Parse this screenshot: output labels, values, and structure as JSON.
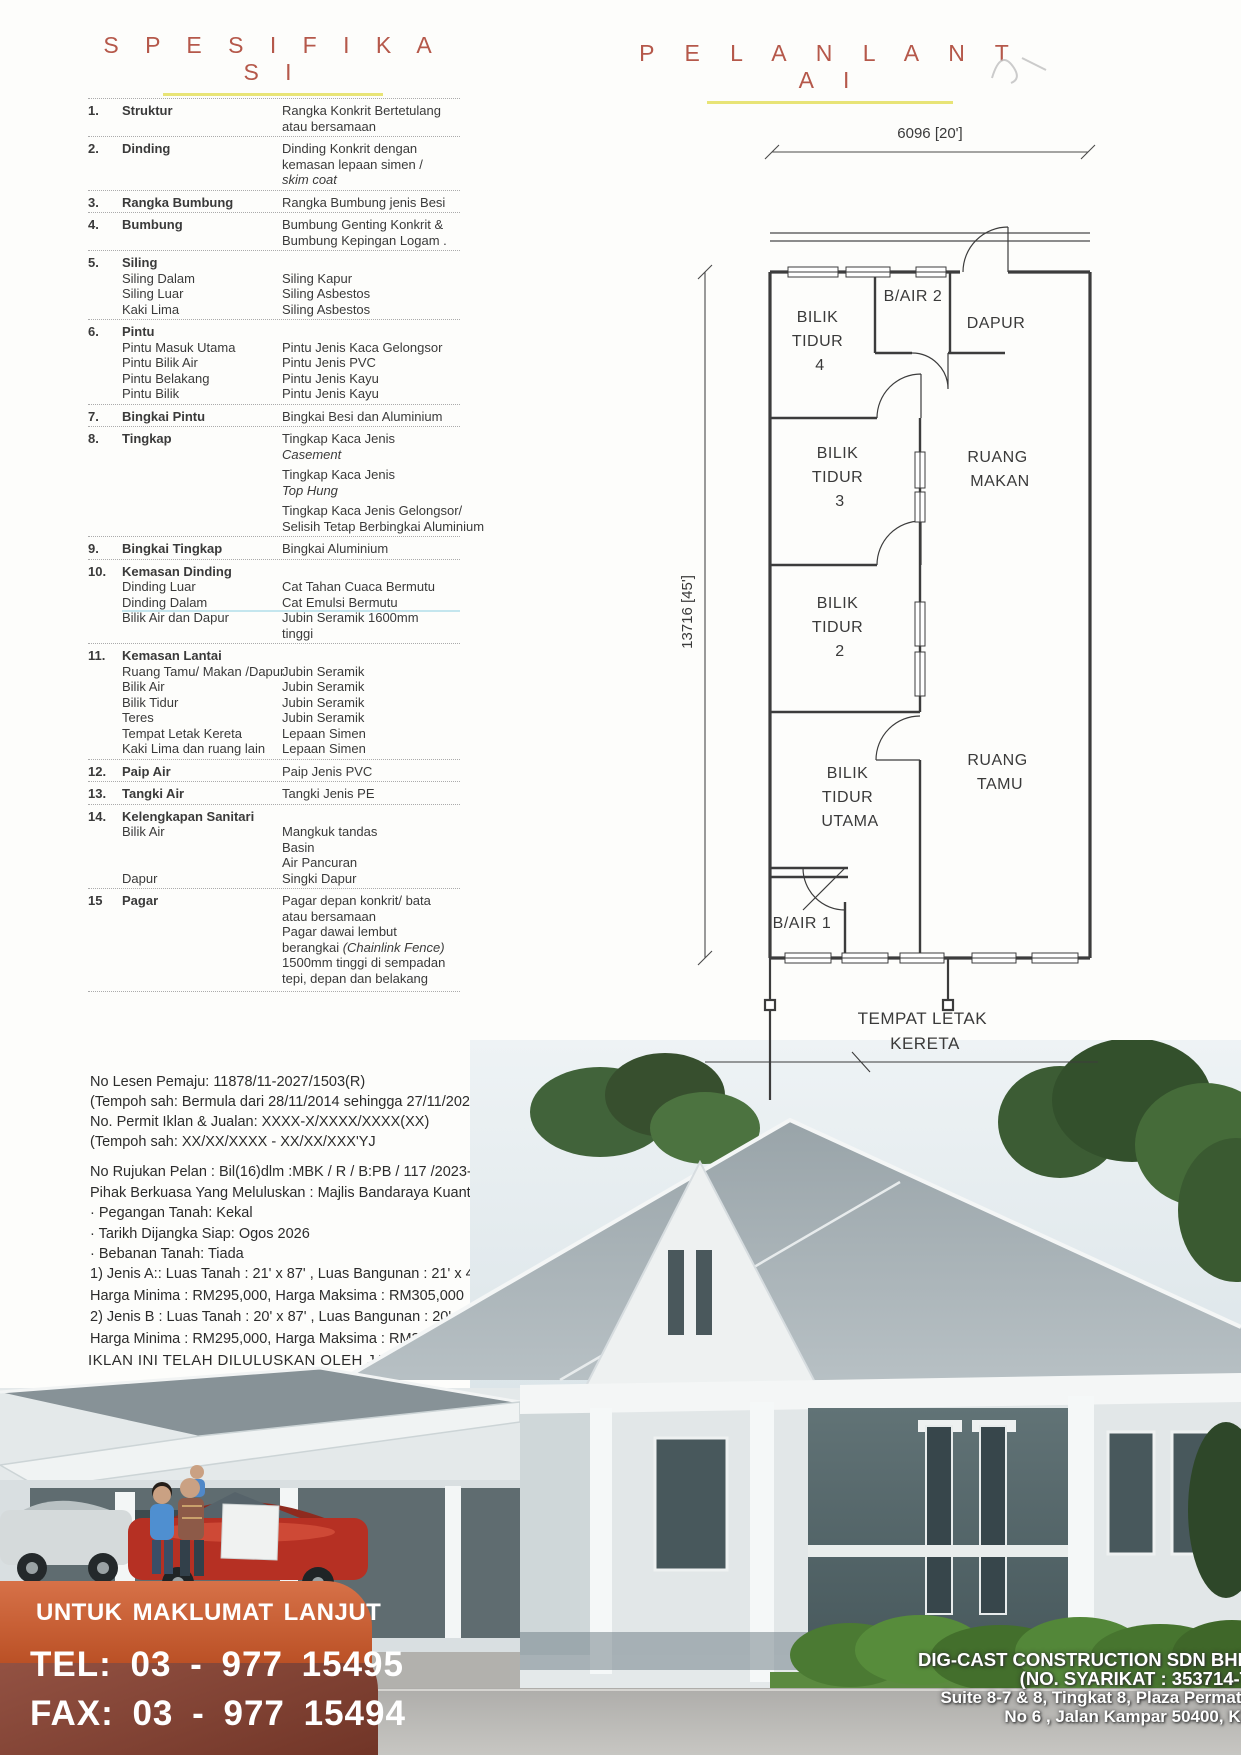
{
  "colors": {
    "accent": "#b5584a",
    "underline": "#e8e476",
    "banner-orange": "#d05a2a",
    "banner-dark": "#8a4130"
  },
  "headings": {
    "spec": "S P E S I F I K A S I",
    "plan": "P E L A N   L A N T A I"
  },
  "spec_table": {
    "rows": [
      {
        "num": "1.",
        "label": "Struktur",
        "values": [
          {
            "t": "Rangka Konkrit Bertetulang"
          },
          {
            "t": "atau bersamaan"
          }
        ]
      },
      {
        "num": "2.",
        "label": "Dinding",
        "values": [
          {
            "t": "Dinding Konkrit dengan"
          },
          {
            "t": "kemasan lepaan simen /"
          },
          {
            "t": "skim coat",
            "i": true
          }
        ]
      },
      {
        "num": "3.",
        "label": "Rangka Bumbung",
        "values": [
          {
            "t": "Rangka Bumbung jenis Besi"
          }
        ]
      },
      {
        "num": "4.",
        "label": "Bumbung",
        "values": [
          {
            "t": "Bumbung Genting Konkrit &"
          },
          {
            "t": "Bumbung Kepingan Logam ."
          }
        ]
      },
      {
        "num": "5.",
        "label": "Siling",
        "sub": [
          {
            "label": "Siling Dalam",
            "values": [
              {
                "t": "Siling Kapur"
              }
            ]
          },
          {
            "label": "Siling Luar",
            "values": [
              {
                "t": "Siling Asbestos"
              }
            ]
          },
          {
            "label": "Kaki Lima",
            "values": [
              {
                "t": "Siling Asbestos"
              }
            ]
          }
        ]
      },
      {
        "num": "6.",
        "label": "Pintu",
        "sub": [
          {
            "label": "Pintu Masuk Utama",
            "values": [
              {
                "t": "Pintu Jenis Kaca Gelongsor"
              }
            ]
          },
          {
            "label": "Pintu Bilik Air",
            "values": [
              {
                "t": "Pintu Jenis PVC"
              }
            ]
          },
          {
            "label": "Pintu Belakang",
            "values": [
              {
                "t": "Pintu Jenis Kayu"
              }
            ]
          },
          {
            "label": "Pintu Bilik",
            "values": [
              {
                "t": "Pintu Jenis Kayu"
              }
            ]
          }
        ]
      },
      {
        "num": "7.",
        "label": "Bingkai Pintu",
        "values": [
          {
            "t": "Bingkai Besi dan Aluminium"
          }
        ]
      },
      {
        "num": "8.",
        "label": "Tingkap",
        "values": [
          {
            "t": "Tingkap Kaca Jenis"
          },
          {
            "t": "Casement",
            "i": true
          },
          {
            "t": "Tingkap Kaca Jenis",
            "g": true
          },
          {
            "t": "Top Hung",
            "i": true
          },
          {
            "t": "Tingkap Kaca Jenis Gelongsor/",
            "g": true
          },
          {
            "t": "Selisih Tetap Berbingkai Aluminium"
          }
        ]
      },
      {
        "num": "9.",
        "label": "Bingkai Tingkap",
        "values": [
          {
            "t": "Bingkai Aluminium"
          }
        ]
      },
      {
        "num": "10.",
        "label": "Kemasan Dinding",
        "sub": [
          {
            "label": "Dinding Luar",
            "values": [
              {
                "t": "Cat Tahan Cuaca Bermutu"
              }
            ]
          },
          {
            "label": "Dinding Dalam",
            "hl": true,
            "values": [
              {
                "t": "Cat Emulsi Bermutu",
                "hl": true
              }
            ]
          },
          {
            "label": "Bilik Air dan Dapur",
            "values": [
              {
                "t": "Jubin Seramik 1600mm"
              },
              {
                "t": "tinggi"
              }
            ]
          }
        ]
      },
      {
        "num": "11.",
        "label": "Kemasan Lantai",
        "sub": [
          {
            "label": "Ruang Tamu/ Makan /Dapur",
            "values": [
              {
                "t": "Jubin Seramik"
              }
            ]
          },
          {
            "label": "Bilik Air",
            "values": [
              {
                "t": "Jubin Seramik"
              }
            ]
          },
          {
            "label": "Bilik Tidur",
            "values": [
              {
                "t": "Jubin Seramik"
              }
            ]
          },
          {
            "label": "Teres",
            "values": [
              {
                "t": "Jubin Seramik"
              }
            ]
          },
          {
            "label": "Tempat Letak Kereta",
            "values": [
              {
                "t": "Lepaan Simen"
              }
            ]
          },
          {
            "label": "Kaki Lima dan ruang lain",
            "values": [
              {
                "t": "Lepaan Simen"
              }
            ]
          }
        ]
      },
      {
        "num": "12.",
        "label": "Paip Air",
        "values": [
          {
            "t": "Paip Jenis PVC"
          }
        ]
      },
      {
        "num": "13.",
        "label": "Tangki Air",
        "values": [
          {
            "t": "Tangki Jenis PE"
          }
        ]
      },
      {
        "num": "14.",
        "label": "Kelengkapan Sanitari",
        "sub": [
          {
            "label": "Bilik Air",
            "values": [
              {
                "t": "Mangkuk tandas"
              },
              {
                "t": "Basin"
              },
              {
                "t": "Air Pancuran"
              }
            ]
          },
          {
            "label": "Dapur",
            "values": [
              {
                "t": "Singki Dapur"
              }
            ]
          }
        ]
      },
      {
        "num": "15",
        "label": "Pagar",
        "values": [
          {
            "t": "Pagar depan konkrit/ bata"
          },
          {
            "t": "atau bersamaan"
          },
          {
            "t": "Pagar dawai lembut"
          },
          {
            "t": "berangkai ",
            "it": "(Chainlink Fence)"
          },
          {
            "t": "1500mm tinggi di sempadan"
          },
          {
            "t": "tepi, depan dan belakang"
          }
        ]
      }
    ]
  },
  "license_block": [
    "No Lesen Pemaju: 11878/11-2027/1503(R)",
    "(Tempoh sah: Bermula dari 28/11/2014 sehingga 27/11/2027)",
    "No. Permit Iklan & Jualan: XXXX-X/XXXX/XXXX(XX)",
    "(Tempoh sah: XX/XX/XXXX - XX/XX/XXX'YJ"
  ],
  "plan_ref_block": [
    "No Rujukan Pelan : Bil(16)dlm :MBK / R / B:PB / 117 /2023-H",
    "Pihak Berkuasa Yang Meluluskan : Majlis Bandaraya Kuantan",
    "· Pegangan Tanah: Kekal",
    "· Tarikh Dijangka Siap: Ogos 2026",
    "· Bebanan Tanah: Tiada"
  ],
  "pricing_block": [
    "1) Jenis A:: Luas Tanah : 21' x 87' , Luas Bangunan : 21' x 45', Jumlah Unit :12 unit",
    "Harga Minima : RM295,000, Harga Maksima : RM305,000",
    "2) Jenis B : Luas Tanah : 20' x 87' , Luas Bangunan : 20' x 45', Jumlah Unit  :11 unit",
    "Harga Minima : RM295,000, Harga Maksima : RM335,000"
  ],
  "approval_line": "IKLAN INI TELAH DILULUSKAN OLEH JABATAN PERUMAHAN NEGARA",
  "floor_plan": {
    "dim_width": "6096 [20']",
    "dim_height": "13716 [45']",
    "rooms": {
      "bt4": [
        "BILIK",
        "TIDUR",
        "4"
      ],
      "bair2": [
        "B/AIR 2"
      ],
      "dapur": [
        "DAPUR"
      ],
      "bt3": [
        "BILIK",
        "TIDUR",
        "3"
      ],
      "rmakan": [
        "RUANG",
        "MAKAN"
      ],
      "bt2": [
        "BILIK",
        "TIDUR",
        "2"
      ],
      "rtamu": [
        "RUANG",
        "TAMU"
      ],
      "btutama": [
        "BILIK",
        "TIDUR",
        "UTAMA"
      ],
      "bair1": [
        "B/AIR 1"
      ],
      "tlk": [
        "TEMPAT LETAK",
        "KERETA"
      ]
    }
  },
  "contact": {
    "heading": "UNTUK MAKLUMAT LANJUT",
    "tel": "TEL: 03 - 977 15495",
    "fax": "FAX: 03 - 977 15494"
  },
  "developer": {
    "name": "DIG-CAST CONSTRUCTION SDN BHD",
    "reg": "(NO. SYARIKAT : 353714-T",
    "addr1": "Suite 8-7 & 8, Tingkat 8, Plaza Permata",
    "addr2": "No 6 , Jalan Kampar 50400, KL"
  }
}
